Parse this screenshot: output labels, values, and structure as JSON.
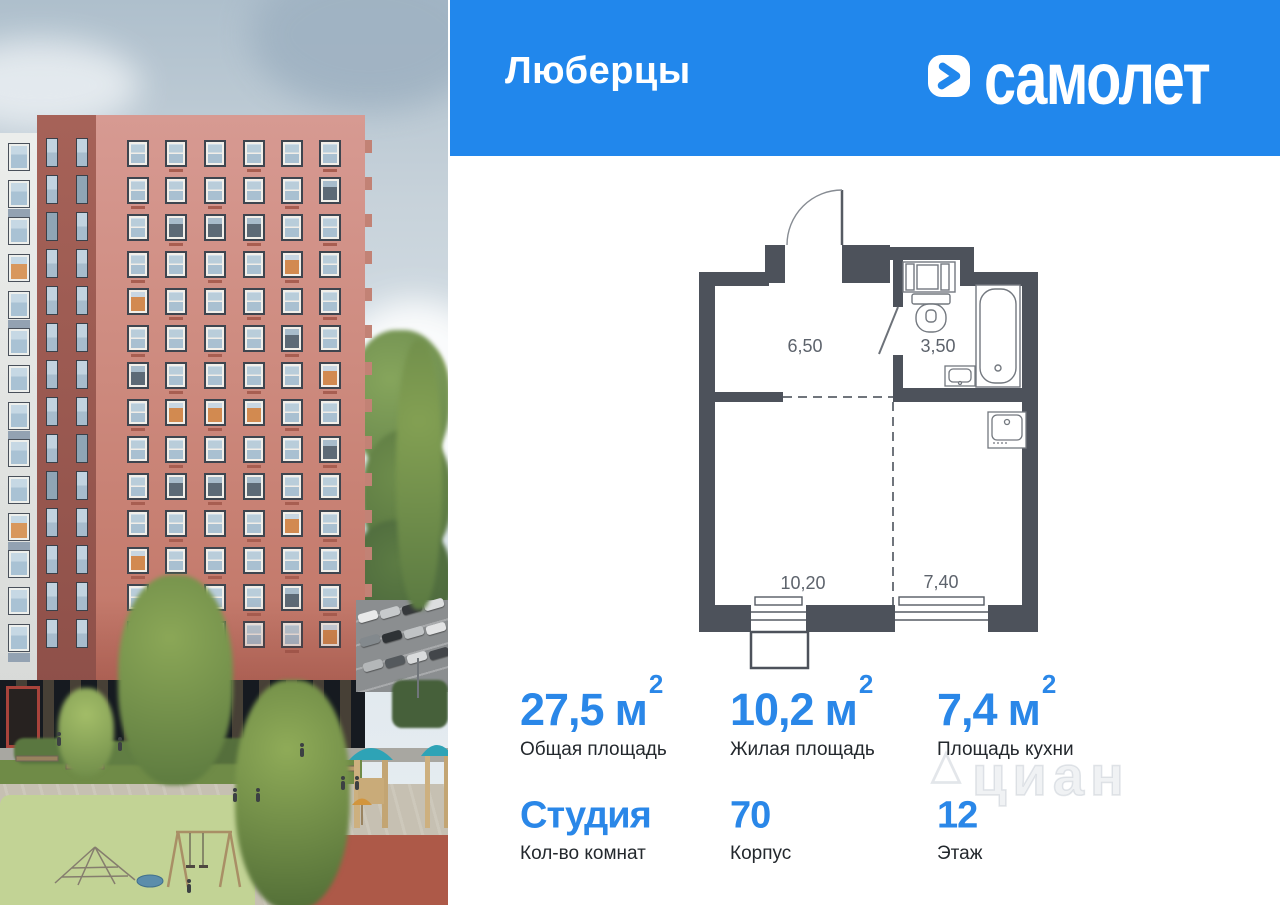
{
  "header": {
    "title": "Люберцы",
    "brand": "самолет",
    "banner_color": "#2187EC"
  },
  "floor_plan": {
    "rooms": [
      {
        "name": "hallway",
        "area": "6,50"
      },
      {
        "name": "bathroom",
        "area": "3,50"
      },
      {
        "name": "living-room",
        "area": "10,20"
      },
      {
        "name": "kitchen",
        "area": "7,40"
      }
    ]
  },
  "stats": {
    "items": [
      {
        "value": "27,5",
        "unit": "м",
        "sup": "2",
        "label": "Общая площадь"
      },
      {
        "value": "10,2",
        "unit": "м",
        "sup": "2",
        "label": "Жилая площадь"
      },
      {
        "value": "7,4",
        "unit": "м",
        "sup": "2",
        "label": "Площадь кухни"
      },
      {
        "value": "Студия",
        "unit": "",
        "sup": "",
        "label": "Кол-во комнат"
      },
      {
        "value": "70",
        "unit": "",
        "sup": "",
        "label": "Корпус"
      },
      {
        "value": "12",
        "unit": "",
        "sup": "",
        "label": "Этаж"
      }
    ]
  },
  "watermark": {
    "text": "циан"
  },
  "accent_blue": "#2A87E8"
}
